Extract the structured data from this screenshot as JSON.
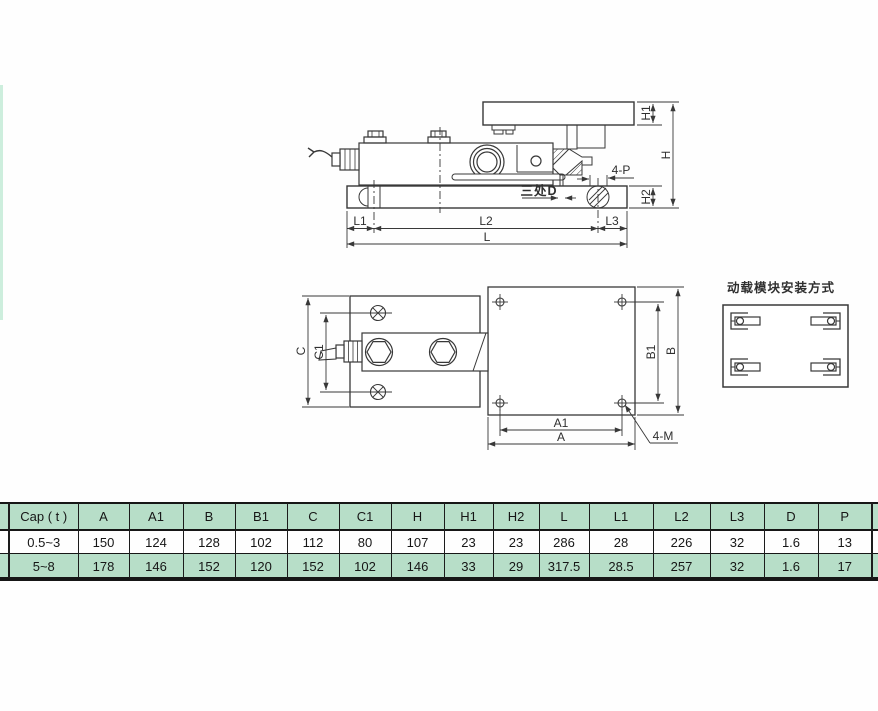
{
  "drawing": {
    "side_view": {
      "labels": {
        "h1": "H1",
        "h": "H",
        "h2": "H2",
        "four_p": "4-P",
        "three_places_d": "三处D",
        "l1": "L1",
        "l2": "L2",
        "l3": "L3",
        "l": "L"
      }
    },
    "top_view": {
      "labels": {
        "c": "C",
        "c1": "C1",
        "b1": "B1",
        "b": "B",
        "a1": "A1",
        "a": "A",
        "four_m": "4-M"
      }
    },
    "install_diagram": {
      "title": "动载模块安装方式"
    }
  },
  "table": {
    "headers": [
      "Cap ( t )",
      "A",
      "A1",
      "B",
      "B1",
      "C",
      "C1",
      "H",
      "H1",
      "H2",
      "L",
      "L1",
      "L2",
      "L3",
      "D",
      "P"
    ],
    "rows": [
      [
        "0.5~3",
        "150",
        "124",
        "128",
        "102",
        "112",
        "80",
        "107",
        "23",
        "23",
        "286",
        "28",
        "226",
        "32",
        "1.6",
        "13"
      ],
      [
        "5~8",
        "178",
        "146",
        "152",
        "120",
        "152",
        "102",
        "146",
        "33",
        "29",
        "317.5",
        "28.5",
        "257",
        "32",
        "1.6",
        "17"
      ]
    ]
  },
  "colors": {
    "table_green": "#b7dec8",
    "line": "#383838",
    "rule_black": "#161616"
  }
}
